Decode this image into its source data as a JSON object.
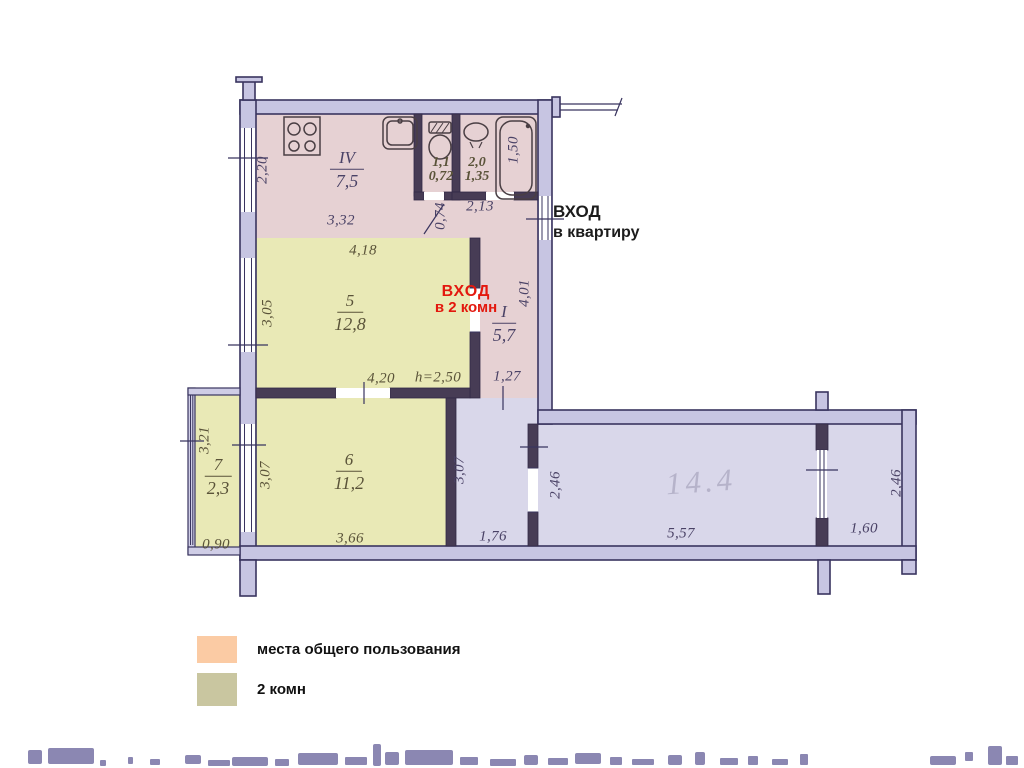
{
  "plan": {
    "entrance_apartment": {
      "line1": "ВХОД",
      "line2": "в квартиру"
    },
    "entrance_2rooms": {
      "line1": "ВХОД",
      "line2": "в 2 комн"
    },
    "rooms": {
      "kitchen": {
        "numeral": "IV",
        "area": "7,5"
      },
      "toilet": {
        "area_top": "1,1",
        "area_bottom": "0,72"
      },
      "bath": {
        "area_top": "2,0",
        "area_bottom": "1,35"
      },
      "room5": {
        "numeral": "5",
        "area": "12,8"
      },
      "hall": {
        "numeral": "I",
        "area": "5,7"
      },
      "room6": {
        "numeral": "6",
        "area": "11,2"
      },
      "balcony": {
        "numeral": "7",
        "area": "2,3"
      },
      "big_room": {
        "handwritten_area": "14.4"
      }
    },
    "dims": {
      "kitchen_height": "2,20",
      "kitchen_width": "3,32",
      "corridor_near_wc": "0,74",
      "bath_width": "2,13",
      "bathtub_length": "1,50",
      "room5_top": "4,18",
      "room5_left": "3,05",
      "room5_bottom": "4,20",
      "ceiling_height": "h=2,50",
      "hall_right": "4,01",
      "hall_bottom": "1,27",
      "room6_left": "3,07",
      "room6_bottom": "3,66",
      "balcony_left": "3,21",
      "balcony_bottom": "0,90",
      "corridor_left": "3,07",
      "corridor_bottom": "1,76",
      "big_room_left": "2,46",
      "big_room_bottom": "5,57",
      "right_section_bottom": "1,60",
      "right_section_right": "2,46"
    }
  },
  "legend": {
    "items": [
      {
        "label": "места общего пользования",
        "color": "#fbcba4"
      },
      {
        "label": "2 комн",
        "color": "#c9c6a0"
      }
    ]
  },
  "colors": {
    "common_area_fill": "#e6d1d3",
    "two_room_fill": "#e9e9b6",
    "corridor_fill": "#d9d7ea",
    "wall_outline": "#39345f",
    "wall_fill": "#c7c5e2",
    "interior_wall": "#473c55",
    "entrance2_red": "#e3180e",
    "legend_common": "#fbcba4",
    "legend_rooms": "#c9c6a0",
    "pencil_gray": "#b6b3ca"
  }
}
